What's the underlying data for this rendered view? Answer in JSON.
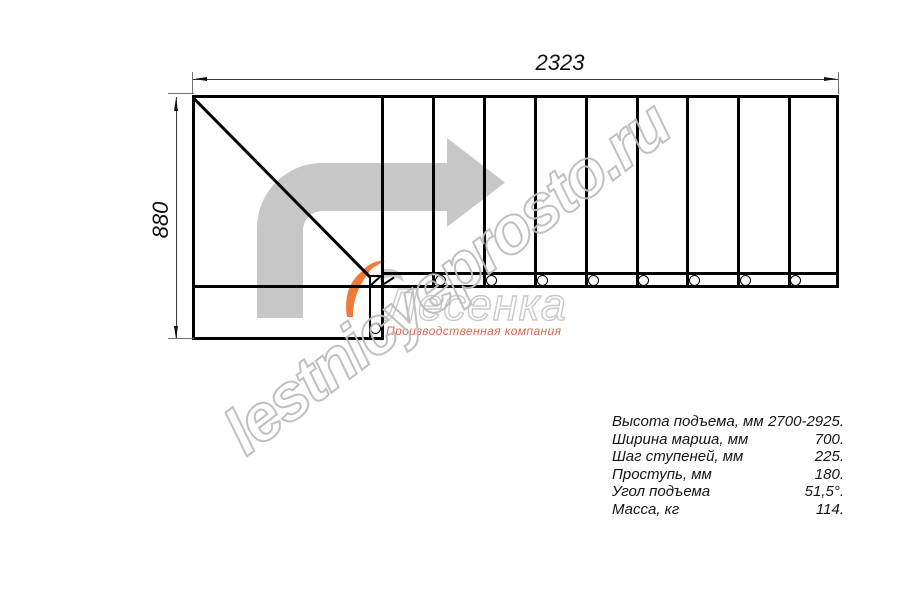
{
  "drawing": {
    "dim_width": "2323",
    "dim_height": "880",
    "watermark": "lestnicyeprosto.ru",
    "logo": {
      "name": "Лесенка",
      "tagline": "Производственная компания",
      "flame_orange": "#ee7b3a",
      "flame_gray": "#cfcfcf"
    },
    "colors": {
      "line": "#000000",
      "direction_arrow": "#c7c7c7",
      "watermark_stroke": "#bdbdbd",
      "logo_stroke": "#c9c9c9",
      "tagline_red": "#e2654f"
    }
  },
  "plan": {
    "first_step_x": 381,
    "step_lines_x": [
      381,
      432,
      483,
      534,
      585,
      636,
      686,
      737,
      788
    ],
    "band_circles_x": [
      440,
      491,
      542,
      593,
      643,
      694,
      745,
      795
    ],
    "band_circle_y": 280,
    "landing_circle": {
      "x": 375,
      "y": 328
    }
  },
  "specs": {
    "rows": [
      {
        "label": "Высота подъема, мм",
        "value": "2700-2925."
      },
      {
        "label": "Ширина марша, мм",
        "value": "700."
      },
      {
        "label": "Шаг ступеней, мм",
        "value": "225."
      },
      {
        "label": "Проступь, мм",
        "value": "180."
      },
      {
        "label": "Угол подъема",
        "value": "51,5°."
      },
      {
        "label": "Масса, кг",
        "value": "114."
      }
    ]
  }
}
